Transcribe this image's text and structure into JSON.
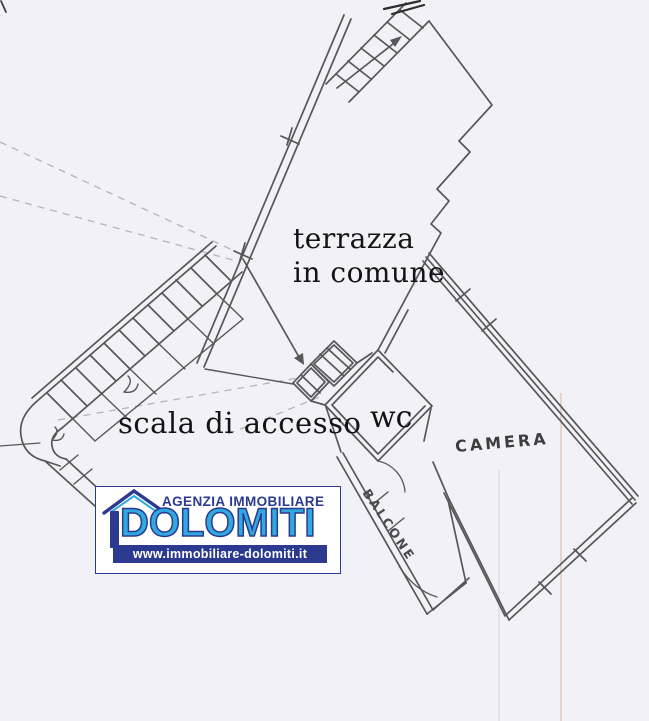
{
  "plan_labels": {
    "terrace_line1": "terrazza",
    "terrace_line2": "in comune",
    "stairs": "scala di accesso",
    "wc": "wc",
    "bedroom": "CAMERA",
    "balcony": "BALCONE"
  },
  "logo": {
    "agency": "AGENZIA IMMOBILIARE",
    "brand": "DOLOMITI",
    "website": "www.immobiliare-dolomiti.it",
    "colors": {
      "navy": "#2b3a8f",
      "sky": "#2fa9e0"
    }
  },
  "canvas": {
    "background": "#f2f1f7",
    "ink": "#575757"
  }
}
